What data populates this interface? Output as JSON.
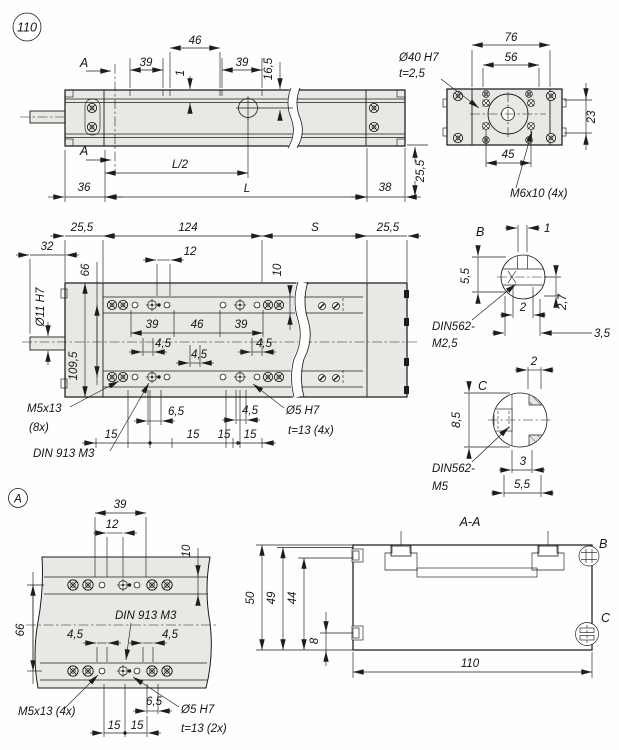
{
  "meta": {
    "figure_badge": "110",
    "colors": {
      "background": "#fefefe",
      "part_fill": "#e8e8e5",
      "line": "#1d1d1d"
    }
  },
  "top_view": {
    "dim_39_left": "39",
    "dim_46": "46",
    "dim_1": "1",
    "dim_39_right": "39",
    "dim_16_5": "16,5",
    "section_label_top": "A",
    "section_label_bottom": "A",
    "dim_l_half": "L/2",
    "dim_l": "L",
    "dim_36": "36",
    "dim_38": "38"
  },
  "end_view": {
    "dim_76": "76",
    "dim_56": "56",
    "label_bore": "Ø40 H7",
    "label_bore_depth": "t=2,5",
    "dim_23": "23",
    "dim_45": "45",
    "label_thread": "M6x10 (4x)",
    "dim_25_5": "25,5"
  },
  "plan_view": {
    "dim_25_5_left": "25,5",
    "dim_124": "124",
    "dim_s": "S",
    "dim_25_5_right": "25,5",
    "dim_32": "32",
    "dim_66": "66",
    "dim_12": "12",
    "dim_10": "10",
    "label_shaft": "Ø11 H7",
    "dim_109_5": "109,5",
    "dim_39_left": "39",
    "dim_46": "46",
    "dim_39_right": "39",
    "dim_4_5_a": "4,5",
    "dim_4_5_b": "4,5",
    "dim_4_5_c": "4,5",
    "dim_4_5_d": "4,5",
    "label_screw": "M5x13",
    "label_screw_qty": "(8x)",
    "label_setscrew": "DIN 913 M3",
    "dim_6_5": "6,5",
    "dim_15_a": "15",
    "dim_15_b": "15",
    "dim_15_c": "15",
    "dim_15_d": "15",
    "label_dowel": "Ø5 H7",
    "label_dowel_depth": "t=13 (4x)"
  },
  "detail_b": {
    "title": "B",
    "dim_1": "1",
    "dim_5_5": "5,5",
    "dim_2": "2",
    "dim_2_7": "2,7",
    "dim_3_5": "3,5",
    "label_line1": "DIN562-",
    "label_line2": "M2,5"
  },
  "detail_c": {
    "title": "C",
    "dim_2": "2",
    "dim_8_5": "8,5",
    "dim_3": "3",
    "dim_5_5": "5,5",
    "label_line1": "DIN562-",
    "label_line2": "M5"
  },
  "detail_a": {
    "badge": "A",
    "dim_39": "39",
    "dim_12": "12",
    "dim_10": "10",
    "dim_66": "66",
    "label_setscrew": "DIN 913 M3",
    "dim_4_5_left": "4,5",
    "dim_4_5_right": "4,5",
    "label_screw": "M5x13 (4x)",
    "dim_6_5": "6,5",
    "dim_15_a": "15",
    "dim_15_b": "15",
    "label_dowel": "Ø5 H7",
    "label_dowel_depth": "t=13 (2x)"
  },
  "section_aa": {
    "title": "A-A",
    "dim_50": "50",
    "dim_49": "49",
    "dim_44": "44",
    "dim_8": "8",
    "dim_110": "110",
    "label_b": "B",
    "label_c": "C"
  }
}
